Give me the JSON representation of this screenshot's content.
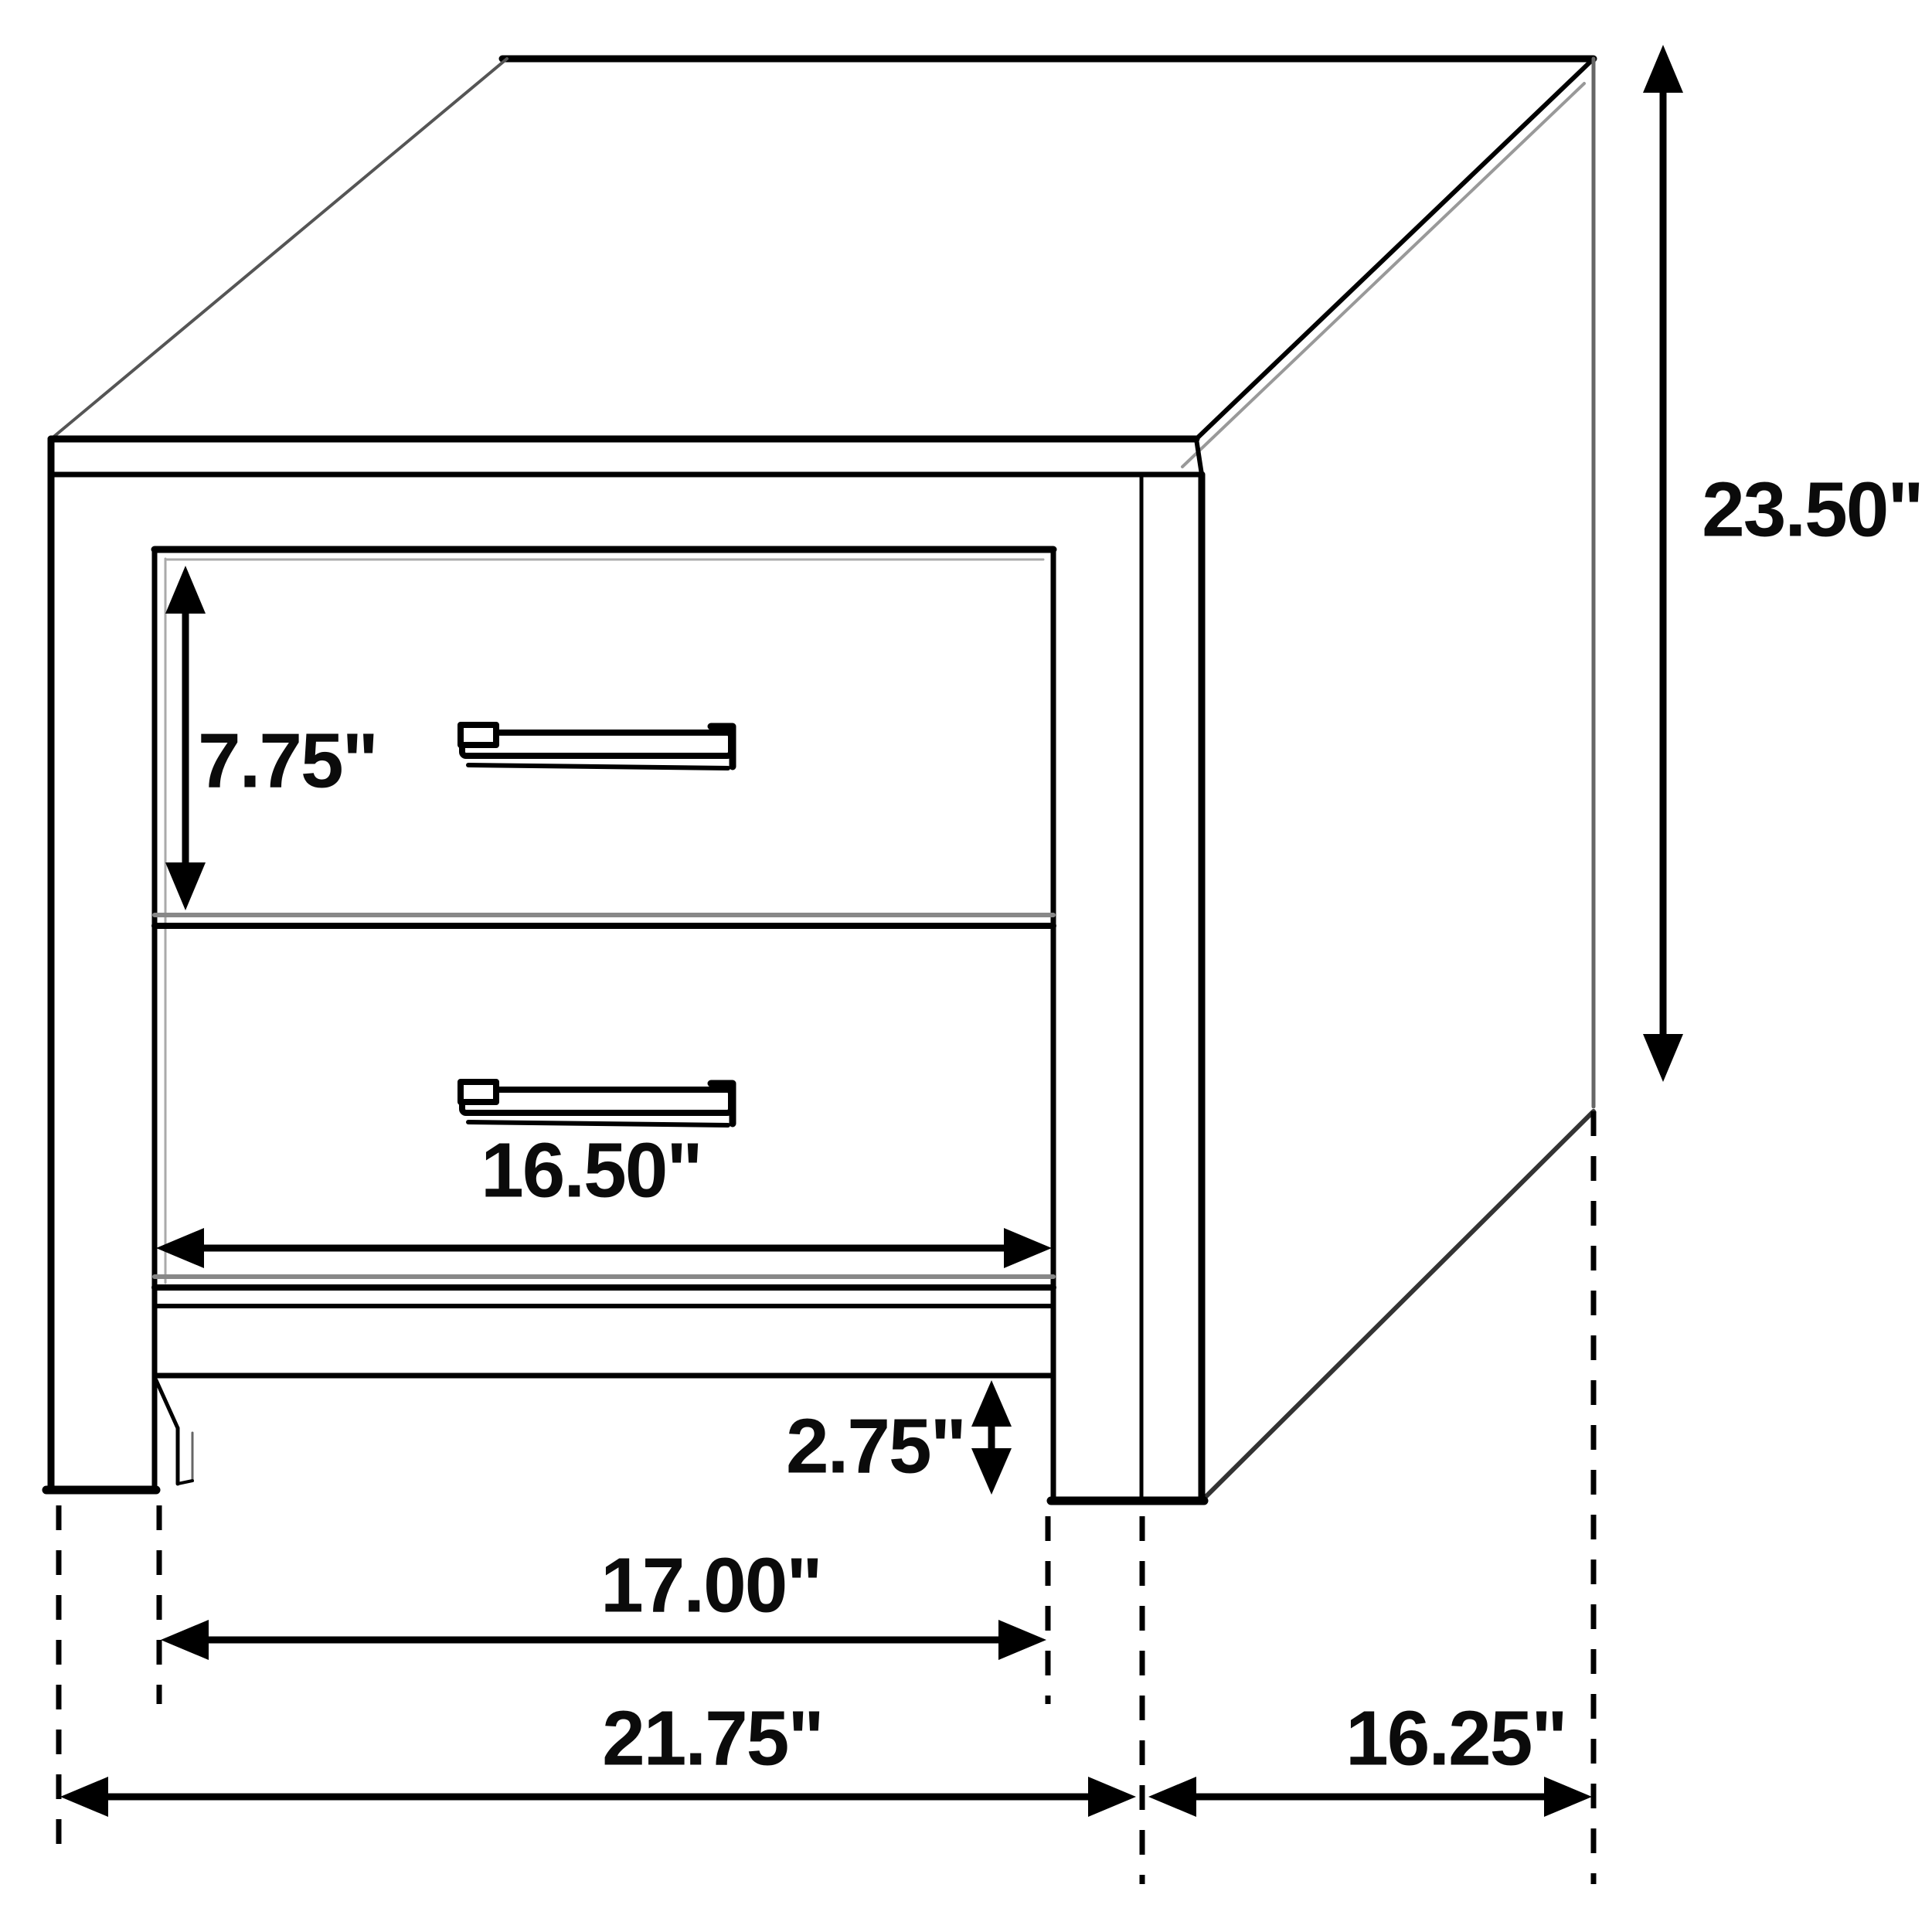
{
  "diagram_title": "Two-drawer nightstand dimension diagram",
  "units": "inches",
  "dimensions": {
    "overall_height": {
      "label": "23.50\""
    },
    "top_drawer_height": {
      "label": "7.75\""
    },
    "drawer_width": {
      "label": "16.50\""
    },
    "foot_height": {
      "label": "2.75\""
    },
    "leg_inner_width": {
      "label": "17.00\""
    },
    "overall_width": {
      "label": "21.75\""
    },
    "overall_depth": {
      "label": "16.25\""
    }
  },
  "colors": {
    "line": "#000000",
    "shade": "#777777",
    "background": "#ffffff"
  }
}
